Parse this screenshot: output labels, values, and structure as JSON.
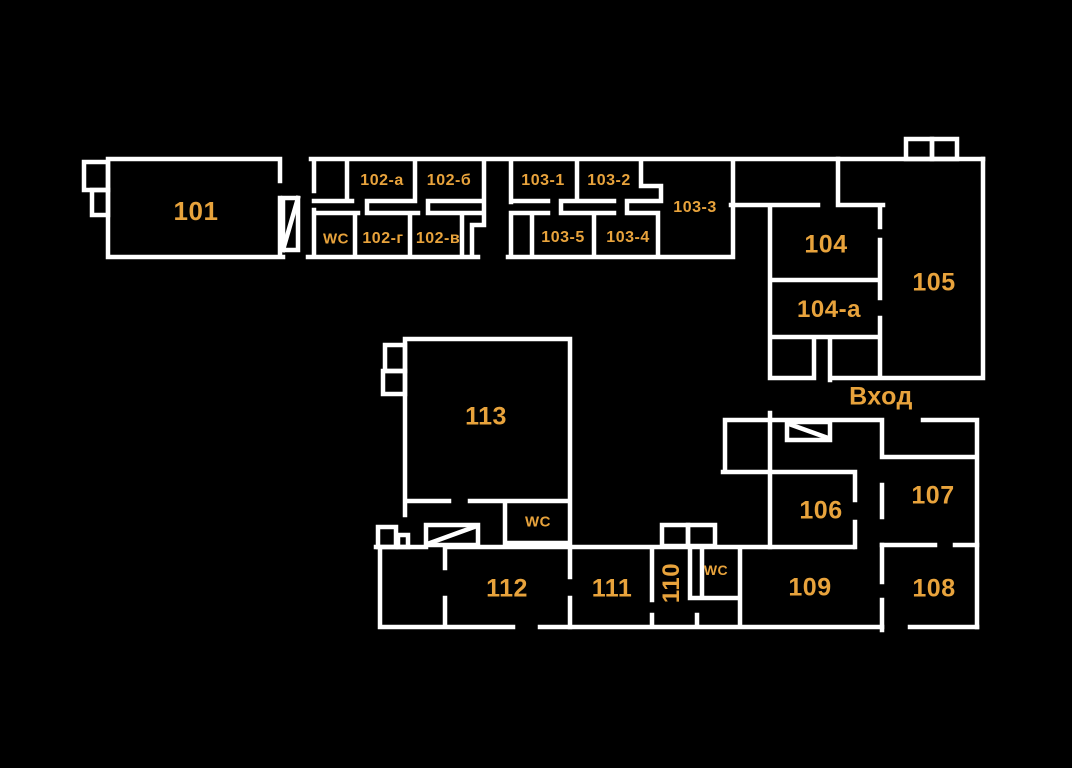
{
  "plan": {
    "type": "building-floor-plan",
    "colors": {
      "background": "#000000",
      "walls": "#ffffff",
      "labels": "#E8A33C"
    },
    "icons": {
      "stairs": "rectangle-with-diagonal-line",
      "annex": "small-outlined-box"
    },
    "rooms": [
      {
        "id": "101",
        "label": "101",
        "x": 196,
        "y": 211,
        "size": 26
      },
      {
        "id": "102a",
        "label": "102-а",
        "x": 382,
        "y": 181,
        "size": 16
      },
      {
        "id": "102b",
        "label": "102-б",
        "x": 449,
        "y": 181,
        "size": 16
      },
      {
        "id": "wc-1",
        "label": "WC",
        "x": 336,
        "y": 239,
        "size": 15
      },
      {
        "id": "102g",
        "label": "102-г",
        "x": 383,
        "y": 239,
        "size": 16
      },
      {
        "id": "102v",
        "label": "102-в",
        "x": 438,
        "y": 239,
        "size": 16
      },
      {
        "id": "103-1",
        "label": "103-1",
        "x": 543,
        "y": 181,
        "size": 16
      },
      {
        "id": "103-2",
        "label": "103-2",
        "x": 609,
        "y": 181,
        "size": 16
      },
      {
        "id": "103-3",
        "label": "103-3",
        "x": 695,
        "y": 208,
        "size": 16
      },
      {
        "id": "103-5",
        "label": "103-5",
        "x": 563,
        "y": 238,
        "size": 16
      },
      {
        "id": "103-4",
        "label": "103-4",
        "x": 628,
        "y": 238,
        "size": 16
      },
      {
        "id": "104",
        "label": "104",
        "x": 826,
        "y": 245,
        "size": 25
      },
      {
        "id": "104a",
        "label": "104-а",
        "x": 829,
        "y": 310,
        "size": 24
      },
      {
        "id": "105",
        "label": "105",
        "x": 934,
        "y": 283,
        "size": 25
      },
      {
        "id": "vhod",
        "label": "Вход",
        "x": 881,
        "y": 397,
        "size": 25
      },
      {
        "id": "113",
        "label": "113",
        "x": 486,
        "y": 417,
        "size": 25
      },
      {
        "id": "wc-2",
        "label": "WC",
        "x": 538,
        "y": 522,
        "size": 15
      },
      {
        "id": "106",
        "label": "106",
        "x": 821,
        "y": 511,
        "size": 25
      },
      {
        "id": "107",
        "label": "107",
        "x": 933,
        "y": 496,
        "size": 25
      },
      {
        "id": "112",
        "label": "112",
        "x": 507,
        "y": 589,
        "size": 25
      },
      {
        "id": "111",
        "label": "111",
        "x": 612,
        "y": 589,
        "size": 25
      },
      {
        "id": "110",
        "label": "110",
        "x": 672,
        "y": 583,
        "size": 24,
        "rotate": -90
      },
      {
        "id": "wc-3",
        "label": "WC",
        "x": 716,
        "y": 570,
        "size": 14
      },
      {
        "id": "109",
        "label": "109",
        "x": 810,
        "y": 588,
        "size": 25
      },
      {
        "id": "108",
        "label": "108",
        "x": 934,
        "y": 589,
        "size": 25
      }
    ]
  }
}
